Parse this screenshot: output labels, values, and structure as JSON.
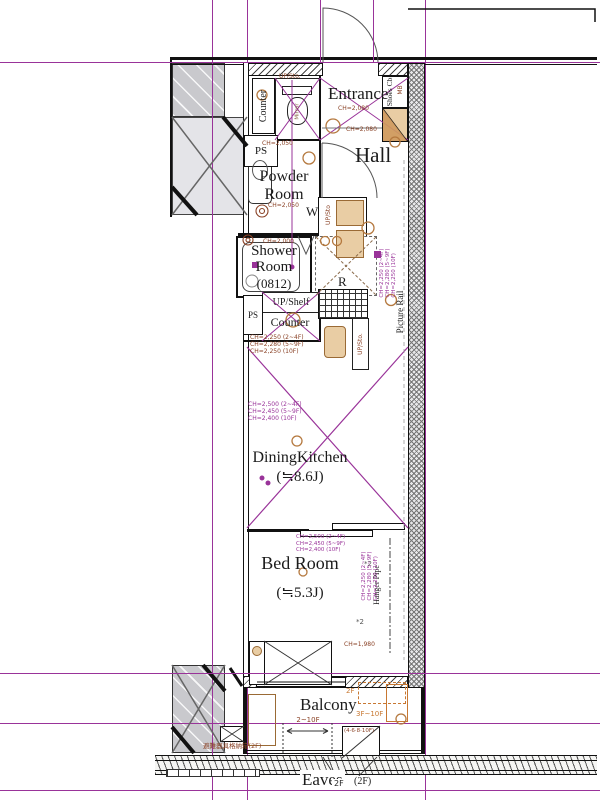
{
  "plan_title": "1K apartment floor plan",
  "colors": {
    "grid_purple": "#993399",
    "annotation_brown": "#8a4226",
    "fixture_tan": "#e9cda4",
    "balcony_orange": "#c87832",
    "wall_gray": "#c9c9cd"
  },
  "rooms": {
    "entrance": {
      "name": "Entrance",
      "ch": "CH=2,080",
      "ch2": "CH=2,080"
    },
    "hall": {
      "name": "Hall"
    },
    "powder_room": {
      "line1": "Powder",
      "line2": "Room",
      "ch_upper": "CH=2,050",
      "ch": "CH=2,050"
    },
    "shower_room": {
      "line1": "Shower",
      "line2": "Room",
      "size": "(0812)",
      "ch": "CH=2,000"
    },
    "dining_kitchen": {
      "name": "DiningKitchen",
      "size": "(≒8.6J)"
    },
    "bed_room": {
      "name": "Bed Room",
      "size": "(≒5.3J)",
      "note1": "*2",
      "note2": "*2",
      "ch_bottom": "CH=1,980"
    },
    "balcony": {
      "name": "Balcony"
    },
    "eaves": {
      "name": "Eaves",
      "floor": "(2F)"
    }
  },
  "fixtures": {
    "counter_top": "Counter",
    "ps_top": "PS",
    "wc_shelf": "UP/Sto.",
    "mirror": "Mirror",
    "shoes_cabinet": "Shoes Cb.",
    "meter_box": "MB",
    "washer": "W",
    "washer_shelf": "UP/Sto",
    "fridge": "R",
    "up_shelf": "UP/Shelf",
    "kitchen_counter": "Counter",
    "ps_mid": "PS",
    "kitchen_storage": "UP/Sto.",
    "picture_rail": "Picture Rail",
    "hanger_pipe": "Hanger Pipe"
  },
  "ch_sets": {
    "counter": [
      "CH=2,250 (2~4F)",
      "CH=2,280 (5~9F)",
      "CH=2,250 (10F)"
    ],
    "picture_rail": [
      "CH=2,250 (2~4F)",
      "CH=2,280 (5~9F)",
      "CH=2,250 (10F)"
    ],
    "hanger": [
      "CH=2,250 (2~4F)",
      "CH=2,280 (5~9F)",
      "CH=2,250 (10F)"
    ],
    "dining": [
      "CH=2,500 (2~4F)",
      "CH=2,450 (5~9F)",
      "CH=2,400 (10F)"
    ],
    "bed": [
      "CH=2,500 (2~4F)",
      "CH=2,450 (5~9F)",
      "CH=2,400 (10F)"
    ]
  },
  "balcony_notes": {
    "upper_floor": "2F",
    "lower_floors": "3F~10F",
    "range": "2~10F",
    "floors_box": "(4·6·8·10F)",
    "storage_box": "避難器具格納箱(2F)",
    "eaves_width_floor": "2F"
  }
}
